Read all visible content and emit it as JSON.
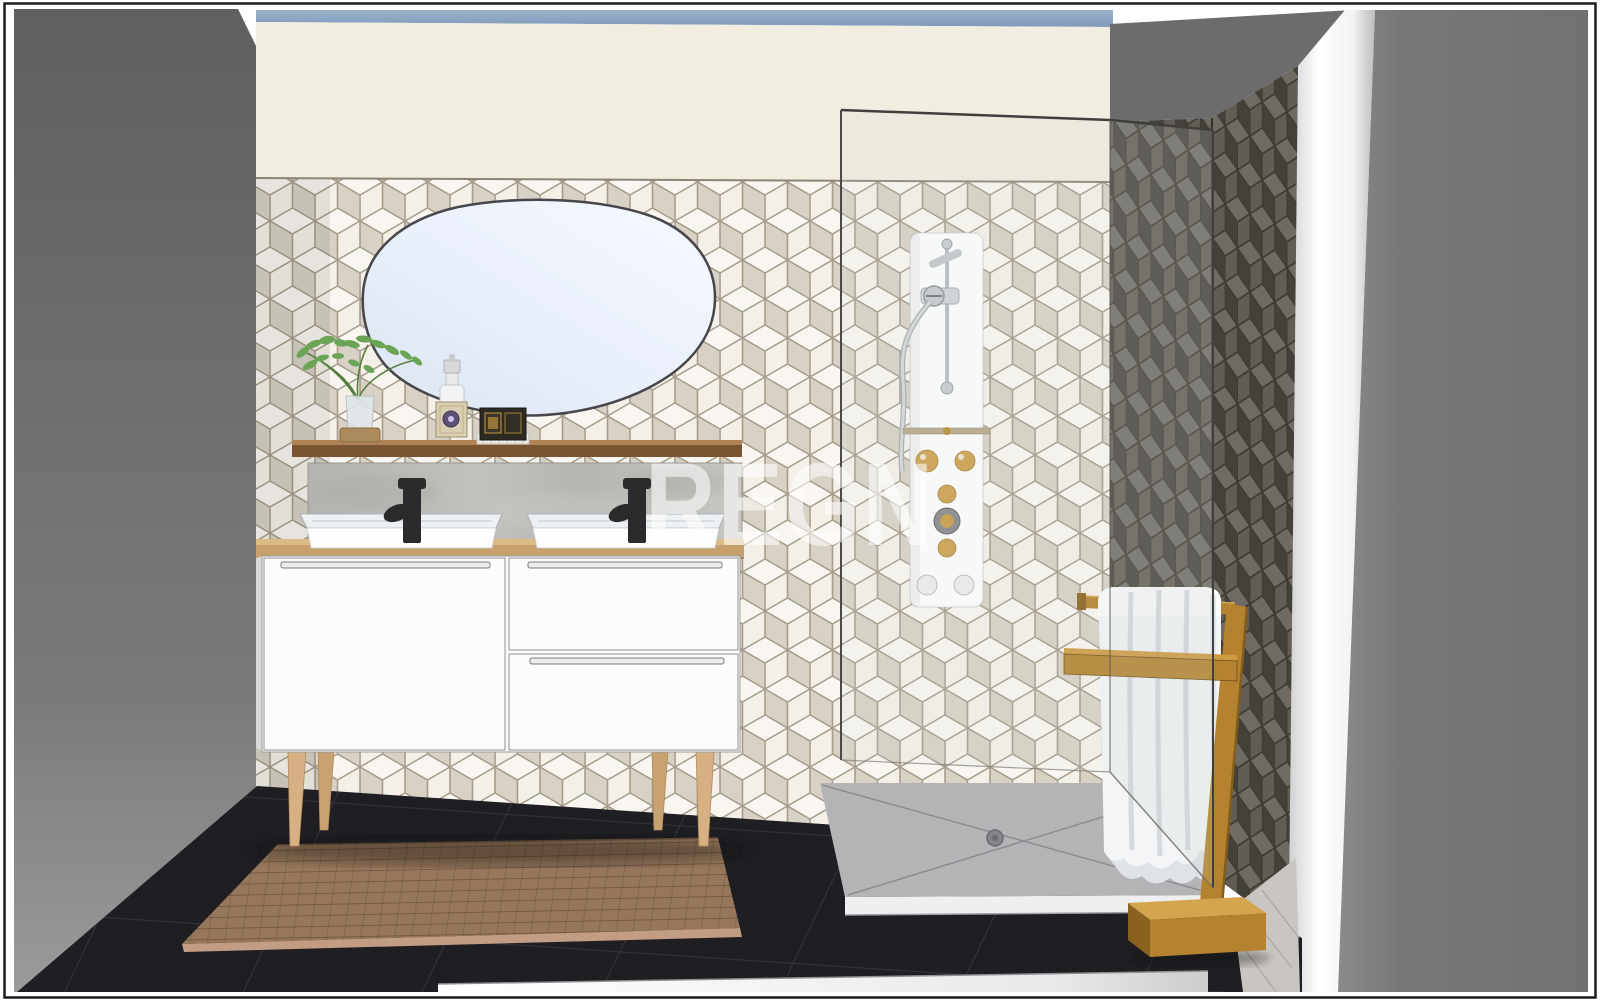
{
  "watermark": {
    "text": "REGN"
  },
  "palette": {
    "frame_border": "#1b1b1b",
    "sky": "#90a8c6",
    "wall_paint": "#f1ede1",
    "tile_base": "#efe9dc",
    "tile_grout": "#a69c8b",
    "wall_gray_upper": "#6c6c6c",
    "dark_wall": "#57534b",
    "wall_right": "#767676",
    "floor": "#1f1f23",
    "rug": "#97775b",
    "rug_edge": "#c39c84",
    "tray": "#b4b3b5",
    "tray_trim": "#edeff0",
    "towel": "#f3f5f7",
    "wood_rack": "#b5832f",
    "shelf_wood": "#7a5432",
    "counter_wood": "#c7a06b",
    "leg_wood": "#d7b183",
    "cabinet": "#fcfcfc",
    "faucet": "#2b2b2e",
    "knob_gold": "#cda04c",
    "plant_green": "#6aa455",
    "watermark_color": "#ffffff"
  }
}
